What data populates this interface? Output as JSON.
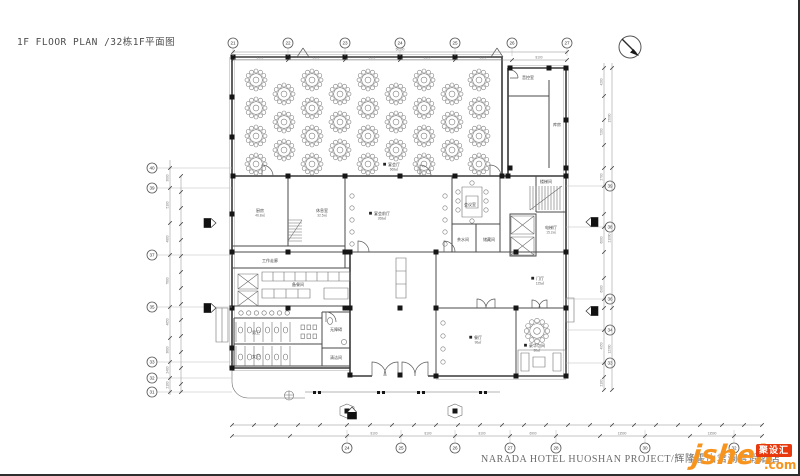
{
  "title": "1F FLOOR PLAN /32栋1F平面图",
  "footer": {
    "project": "NARADA HOTEL HUOSHAN PROJECT/辉隆霍山君澜度假酒店"
  },
  "watermark": {
    "name": "jsheh",
    "tld": ".com",
    "badge": "聚设汇"
  },
  "colors": {
    "line": "#3a3a3a",
    "light_line": "#9e9e9e",
    "text": "#555555",
    "watermark_orange": "#f7941d",
    "watermark_red": "#e8380d"
  },
  "rooms": [
    {
      "n": "宴会厅",
      "a": "668㎡",
      "x": 394,
      "y": 166,
      "sq": 1
    },
    {
      "n": "音控室",
      "a": "",
      "x": 528,
      "y": 79,
      "sq": 0
    },
    {
      "n": "库房",
      "a": "",
      "x": 557,
      "y": 126,
      "sq": 0
    },
    {
      "n": "厨房",
      "a": "46.8㎡",
      "x": 260,
      "y": 212,
      "sq": 0
    },
    {
      "n": "休息室",
      "a": "32.5㎡",
      "x": 322,
      "y": 212,
      "sq": 0
    },
    {
      "n": "宴会前厅",
      "a": "268㎡",
      "x": 382,
      "y": 215,
      "sq": 1
    },
    {
      "n": "会议室",
      "a": "",
      "x": 470,
      "y": 206,
      "sq": 0
    },
    {
      "n": "茶水间",
      "a": "",
      "x": 463,
      "y": 241,
      "sq": 0
    },
    {
      "n": "储藏间",
      "a": "",
      "x": 489,
      "y": 241,
      "sq": 0
    },
    {
      "n": "楼梯间",
      "a": "",
      "x": 546,
      "y": 183,
      "sq": 0
    },
    {
      "n": "电梯厅",
      "a": "15.2㎡",
      "x": 551,
      "y": 229,
      "sq": 0
    },
    {
      "n": "工作走廊",
      "a": "",
      "x": 270,
      "y": 262,
      "sq": 0
    },
    {
      "n": "备餐间",
      "a": "",
      "x": 298,
      "y": 286,
      "sq": 0
    },
    {
      "n": "门厅",
      "a": "125㎡",
      "x": 540,
      "y": 280,
      "sq": 1
    },
    {
      "n": "男卫",
      "a": "",
      "x": 256,
      "y": 334,
      "sq": 0
    },
    {
      "n": "女卫",
      "a": "",
      "x": 256,
      "y": 358,
      "sq": 0
    },
    {
      "n": "无障碍",
      "a": "",
      "x": 336,
      "y": 331,
      "sq": 0
    },
    {
      "n": "清洁间",
      "a": "",
      "x": 336,
      "y": 359,
      "sq": 0
    },
    {
      "n": "餐厅",
      "a": "96㎡",
      "x": 478,
      "y": 339,
      "sq": 1
    },
    {
      "n": "豪华包间",
      "a": "80㎡",
      "x": 537,
      "y": 347,
      "sq": 1
    }
  ],
  "grid": {
    "top": {
      "y": 43,
      "items": [
        {
          "n": "21",
          "x": 233
        },
        {
          "n": "22",
          "x": 288
        },
        {
          "n": "23",
          "x": 345
        },
        {
          "n": "24",
          "x": 400
        },
        {
          "n": "25",
          "x": 455
        },
        {
          "n": "26",
          "x": 512
        },
        {
          "n": "27",
          "x": 567
        }
      ]
    },
    "bottom": {
      "y": 448,
      "items": [
        {
          "n": "24",
          "x": 347
        },
        {
          "n": "25",
          "x": 401
        },
        {
          "n": "26",
          "x": 455
        },
        {
          "n": "27",
          "x": 510
        },
        {
          "n": "28",
          "x": 556
        },
        {
          "n": "30",
          "x": 645
        },
        {
          "n": "32",
          "x": 734
        }
      ]
    },
    "left": {
      "x": 152,
      "items": [
        {
          "n": "40",
          "y": 168
        },
        {
          "n": "39",
          "y": 188
        },
        {
          "n": "37",
          "y": 255
        },
        {
          "n": "35",
          "y": 307
        },
        {
          "n": "33",
          "y": 362
        },
        {
          "n": "32",
          "y": 378
        },
        {
          "n": "31",
          "y": 392
        }
      ]
    },
    "right": {
      "x": 610,
      "items": [
        {
          "n": "39",
          "y": 186
        },
        {
          "n": "38",
          "y": 227
        },
        {
          "n": "36",
          "y": 299
        },
        {
          "n": "34",
          "y": 330
        },
        {
          "n": "33",
          "y": 363
        }
      ]
    }
  },
  "dims": [
    {
      "o": "h",
      "at": 52,
      "a": 233,
      "b": 567,
      "t": [
        233,
        567
      ],
      "labels": [
        {
          "p": 400,
          "v": "50100"
        }
      ]
    },
    {
      "o": "h",
      "at": 60,
      "a": 233,
      "b": 567,
      "t": [
        233,
        288,
        345,
        400,
        455,
        512,
        567
      ],
      "labels": [
        {
          "p": 260,
          "v": "8100"
        },
        {
          "p": 316,
          "v": "8100"
        },
        {
          "p": 372,
          "v": "8100"
        },
        {
          "p": 427,
          "v": "8100"
        },
        {
          "p": 483,
          "v": "8100"
        },
        {
          "p": 539,
          "v": "8100"
        }
      ]
    },
    {
      "o": "h",
      "at": 425,
      "a": 232,
      "b": 762,
      "t": [
        232,
        254,
        276,
        298,
        320,
        347,
        370,
        392,
        414,
        436,
        458,
        480,
        502,
        524,
        546,
        568,
        590,
        612,
        634,
        656,
        678,
        700,
        722,
        744,
        762
      ],
      "labels": []
    },
    {
      "o": "h",
      "at": 436,
      "a": 232,
      "b": 762,
      "t": [
        232,
        290,
        347,
        401,
        455,
        510,
        556,
        600,
        645,
        690,
        734,
        762
      ],
      "labels": [
        {
          "p": 374,
          "v": "8100"
        },
        {
          "p": 428,
          "v": "8100"
        },
        {
          "p": 482,
          "v": "8100"
        },
        {
          "p": 533,
          "v": "6900"
        },
        {
          "p": 622,
          "v": "13500"
        },
        {
          "p": 712,
          "v": "13500"
        }
      ]
    },
    {
      "o": "v",
      "at": 170,
      "a": 160,
      "b": 395,
      "t": [
        168,
        188,
        223,
        255,
        307,
        338,
        362,
        378,
        392
      ],
      "labels": [
        {
          "p": 178,
          "v": "3000"
        },
        {
          "p": 205,
          "v": "5100"
        },
        {
          "p": 239,
          "v": "4800"
        },
        {
          "p": 281,
          "v": "7800"
        },
        {
          "p": 322,
          "v": "4650"
        },
        {
          "p": 350,
          "v": "3600"
        },
        {
          "p": 370,
          "v": "2400"
        },
        {
          "p": 385,
          "v": "2100"
        }
      ]
    },
    {
      "o": "v",
      "at": 181,
      "a": 176,
      "b": 392,
      "t": [
        176,
        192,
        208,
        224,
        240,
        256,
        272,
        288,
        304,
        320,
        336,
        352,
        368,
        384,
        392
      ],
      "labels": []
    },
    {
      "o": "v",
      "at": 604,
      "a": 63,
      "b": 390,
      "t": [
        68,
        96,
        120,
        145,
        168,
        186,
        214,
        227,
        252,
        278,
        299,
        308,
        330,
        363,
        377,
        390
      ],
      "labels": [
        {
          "p": 82,
          "v": "4200"
        },
        {
          "p": 132,
          "v": "7200"
        },
        {
          "p": 177,
          "v": "2700"
        },
        {
          "p": 240,
          "v": "6000"
        },
        {
          "p": 289,
          "v": "6900"
        },
        {
          "p": 346,
          "v": "4950"
        },
        {
          "p": 383,
          "v": "2100"
        }
      ]
    },
    {
      "o": "v",
      "at": 612,
      "a": 63,
      "b": 390,
      "t": [
        68,
        168,
        308,
        390
      ],
      "labels": [
        {
          "p": 118,
          "v": "15000"
        },
        {
          "p": 238,
          "v": "21000"
        },
        {
          "p": 349,
          "v": "12300"
        }
      ]
    }
  ],
  "banquet": {
    "seats": 12,
    "rows": [
      {
        "y": 80,
        "xs": [
          256,
          312,
          368,
          424,
          479
        ]
      },
      {
        "y": 94,
        "xs": [
          284,
          340,
          396,
          452
        ]
      },
      {
        "y": 108,
        "xs": [
          256,
          312,
          368,
          424,
          479
        ]
      },
      {
        "y": 122,
        "xs": [
          284,
          340,
          396,
          452
        ]
      },
      {
        "y": 136,
        "xs": [
          256,
          312,
          368,
          424,
          479
        ]
      },
      {
        "y": 150,
        "xs": [
          284,
          340,
          396,
          452
        ]
      },
      {
        "y": 164,
        "xs": [
          256,
          312,
          368,
          424,
          479
        ]
      }
    ]
  },
  "private_table": {
    "x": 537,
    "y": 331,
    "scale": 1.15,
    "seats": 12
  }
}
